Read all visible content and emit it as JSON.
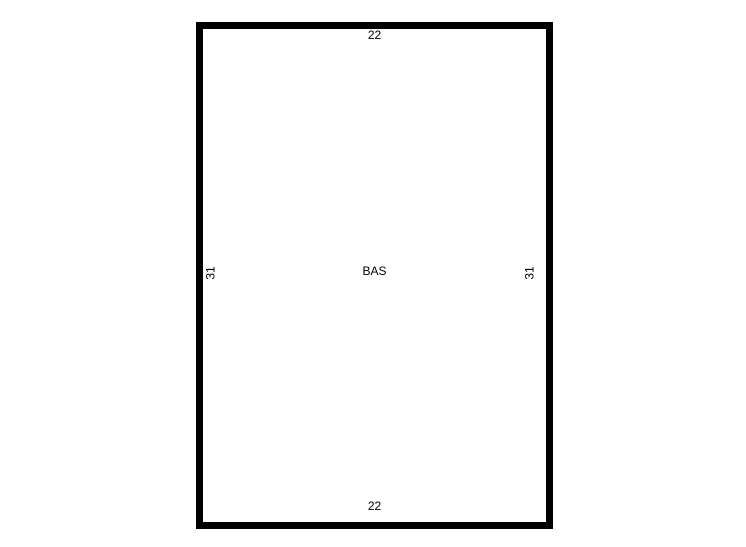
{
  "sketch": {
    "area": {
      "label": "BAS"
    },
    "dimensions": {
      "top": "22",
      "bottom": "22",
      "left": "31",
      "right": "31"
    },
    "colors": {
      "background": "#ffffff",
      "wall": "#000000",
      "text": "#000000"
    }
  }
}
